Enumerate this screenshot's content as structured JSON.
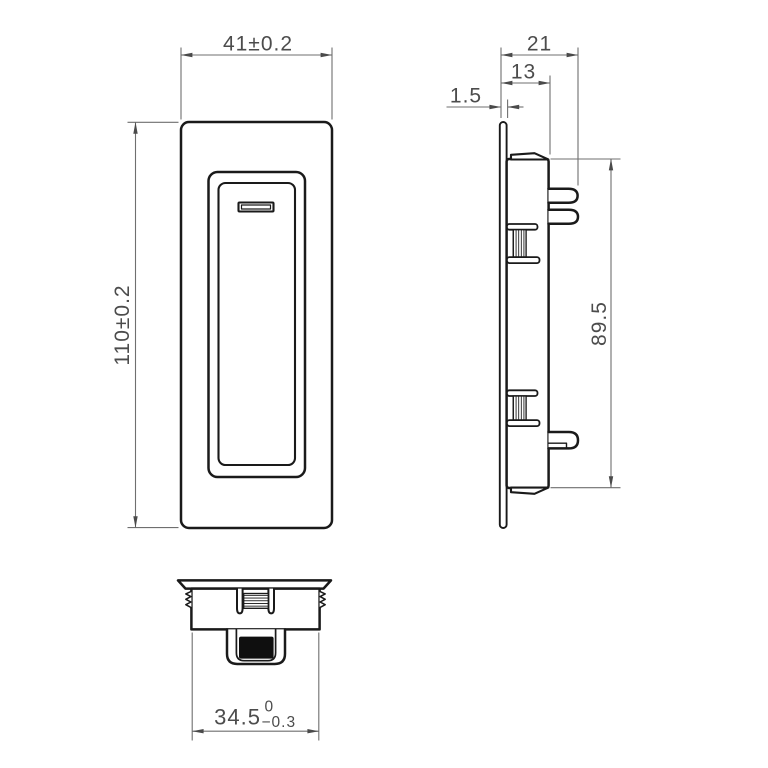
{
  "drawing": {
    "colors": {
      "background": "#ffffff",
      "line": "#1a1a1a",
      "dim": "#6f6f6f",
      "text": "#4c4c4c",
      "arrow": "#4a4a4a",
      "pocket": "#0f0f0f"
    },
    "dimensions": {
      "front_width": "41±0.2",
      "front_height": "110±0.2",
      "overall_depth": "21",
      "body_depth": "13",
      "faceplate_thickness": "1.5",
      "body_height": "89.5",
      "bottom_width": "34.5",
      "bottom_width_tol_upper": "0",
      "bottom_width_tol_lower": "−0.3"
    }
  }
}
